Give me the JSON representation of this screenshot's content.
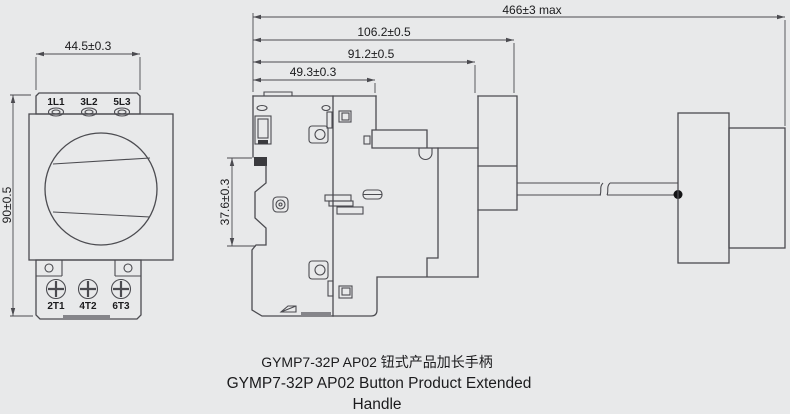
{
  "colors": {
    "background": "#e8e9ea",
    "line": "#4b4b50",
    "text": "#1b1b1d"
  },
  "front_view": {
    "width_dim": "44.5±0.3",
    "height_dim": "90±0.5",
    "top_terminals": [
      "1L1",
      "3L2",
      "5L3"
    ],
    "bottom_terminals": [
      "2T1",
      "4T2",
      "6T3"
    ]
  },
  "side_view": {
    "overall_length_dim": "466±3 max",
    "depth_dims": [
      "106.2±0.5",
      "91.2±0.5",
      "49.3±0.3"
    ],
    "din_rail_dim": "37.6±0.3"
  },
  "caption": {
    "line1": "GYMP7-32P AP02 钮式产品加长手柄",
    "line2": "GYMP7-32P AP02 Button Product Extended",
    "line3": "Handle"
  }
}
